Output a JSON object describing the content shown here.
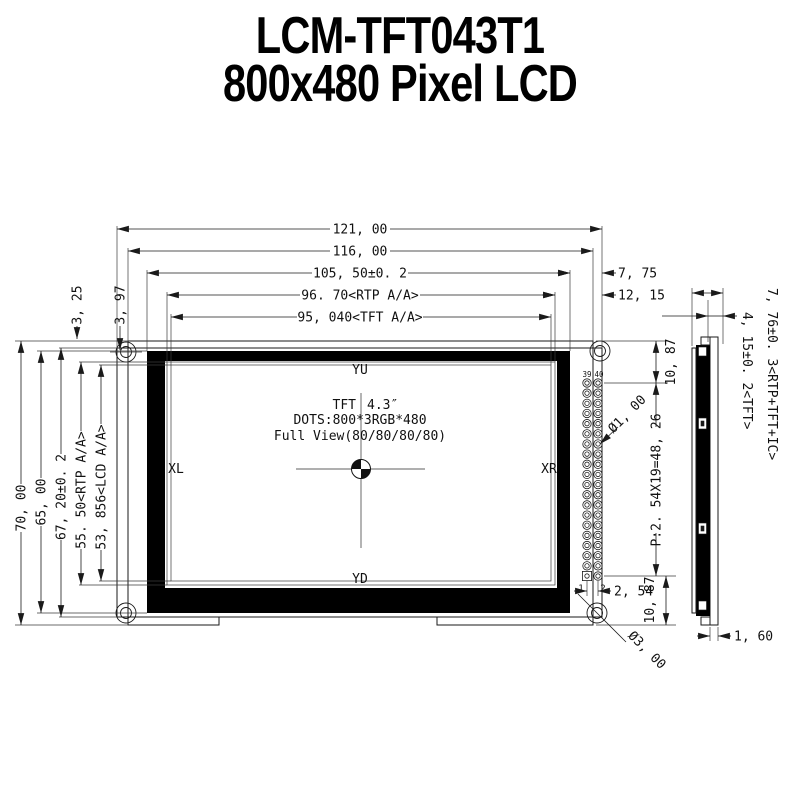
{
  "title": {
    "line1": "LCM-TFT043T1",
    "line2": "800x480 Pixel LCD"
  },
  "front_view": {
    "screen": {
      "label_top": "YU",
      "label_bottom": "YD",
      "label_left": "XL",
      "label_right": "XR",
      "size_left": "TFT",
      "size_right": "4.3″",
      "dots": "DOTS:800*3RGB*480",
      "view_angle": "Full View(80/80/80/80)"
    },
    "connector": {
      "pin39": "39",
      "pin40": "40",
      "pin1": "1",
      "pin2": "2"
    },
    "dims": {
      "width_total": "121, 00",
      "width_pcb": "116, 00",
      "width_module": "105, 50±0. 2",
      "width_rtp_aa": "96. 70<RTP A/A>",
      "width_tft_aa": "95, 040<TFT A/A>",
      "right_offset_bezel": "7, 75",
      "right_offset_aa": "12, 15",
      "corner_offset1": "3, 25",
      "corner_offset2": "3, 97",
      "height_pcb": "70, 00",
      "height_module": "65, 00",
      "height_glass": "67, 20±0. 2",
      "height_rtp_aa": "55. 50<RTP A/A>",
      "height_lcd_aa": "53, 856<LCD A/A>",
      "pin_top_offset": "10, 87",
      "pin_pitch_total": "P:2. 54X19=48, 26",
      "pin_bottom_offset": "10, 87",
      "pin_col_spacing": "2, 54",
      "pin_hole_dia": "Ø1, 00",
      "mount_hole_dia": "Ø3, 00"
    }
  },
  "side_view": {
    "dims": {
      "thickness_total": "7, 76±0. 3<RTP+TFT+IC>",
      "thickness_tft": "4, 15±0. 2<TFT>",
      "thickness_pcb": "1, 60"
    }
  }
}
